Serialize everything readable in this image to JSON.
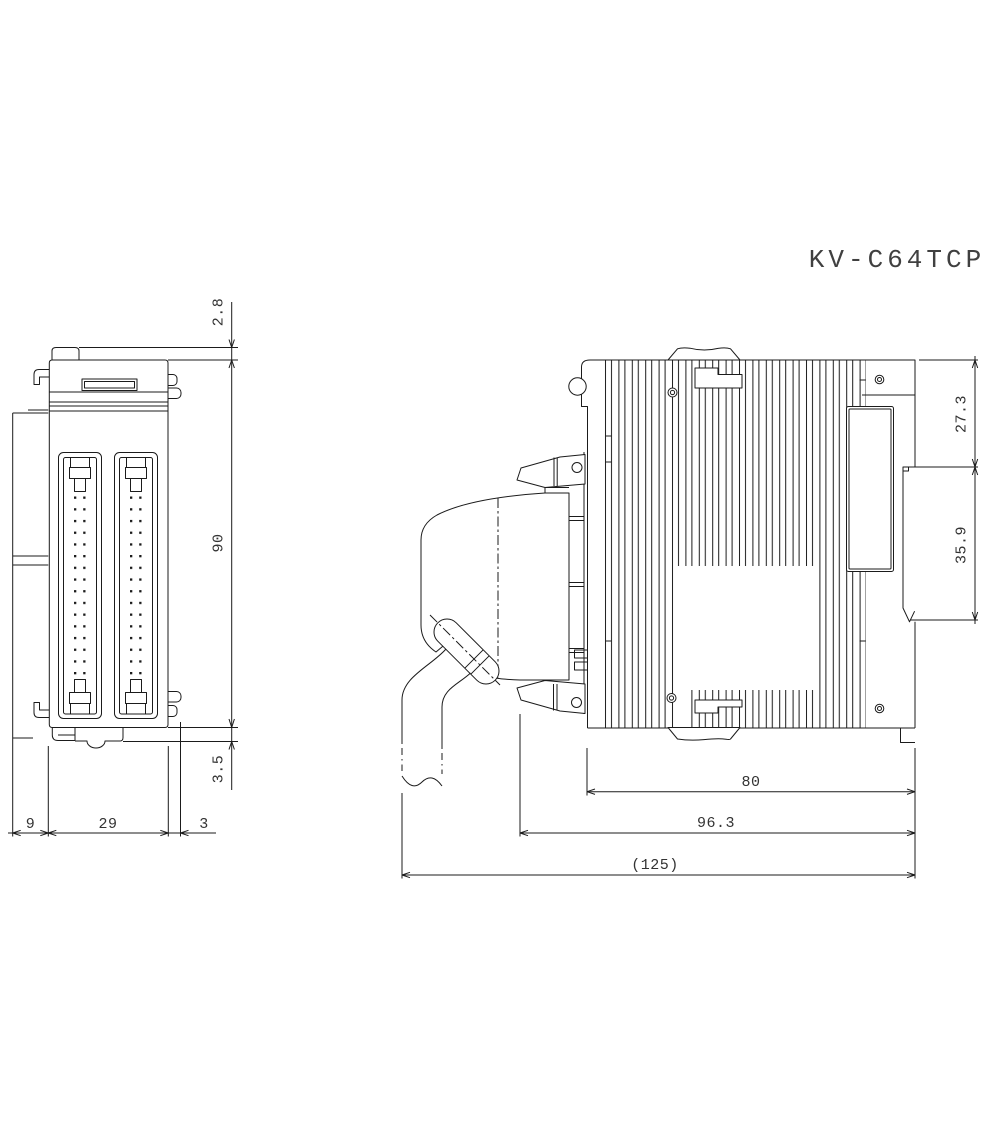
{
  "drawing": {
    "title": "KV-C64TCP",
    "views": {
      "front": "front-view-with-two-ribbon-connectors",
      "side": "side-view-with-heatsink-fins-connector-and-cable"
    },
    "dims": {
      "front_top_clip": "2.8",
      "front_body_height": "90",
      "front_foot": "3.5",
      "front_left_protrusion": "9",
      "front_body_width": "29",
      "front_side_tab": "3",
      "side_upper_section": "27.3",
      "side_rail_section": "35.9",
      "side_body_depth": "80",
      "side_depth_with_connector": "96.3",
      "side_overall_depth": "(125)"
    },
    "colors": {
      "line": "#1b1b1b",
      "background": "#ffffff",
      "text": "#333333",
      "title": "#404040"
    }
  }
}
